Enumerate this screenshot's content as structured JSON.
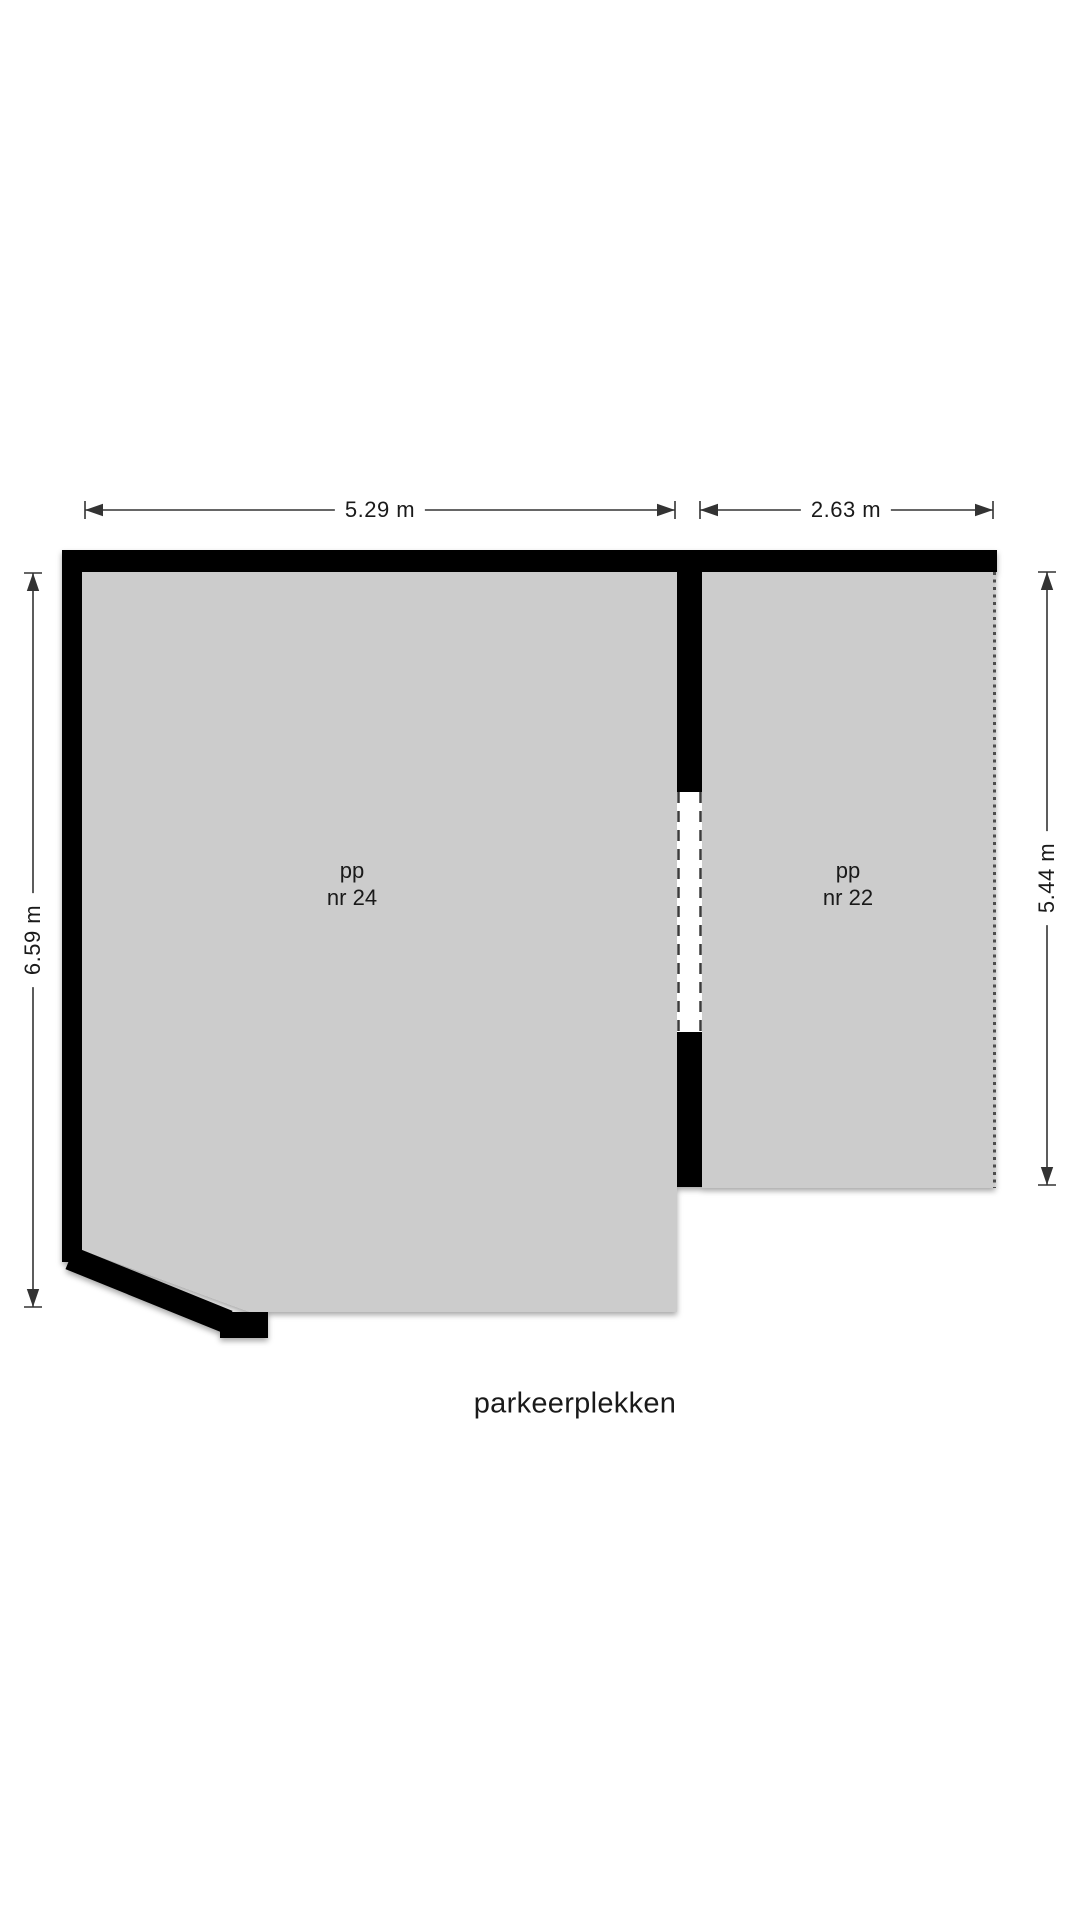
{
  "plan": {
    "caption": "parkeerplekken",
    "rooms": [
      {
        "id": "pp-24",
        "label_line1": "pp",
        "label_line2": "nr 24"
      },
      {
        "id": "pp-22",
        "label_line1": "pp",
        "label_line2": "nr 22"
      }
    ],
    "dimensions": {
      "pp24_width": "5.29 m",
      "pp22_width": "2.63 m",
      "pp24_height": "6.59 m",
      "pp22_height": "5.44 m"
    },
    "colors": {
      "room_fill": "#cccccc",
      "wall": "#000000",
      "dimension_line": "#333333",
      "background": "#ffffff"
    }
  }
}
